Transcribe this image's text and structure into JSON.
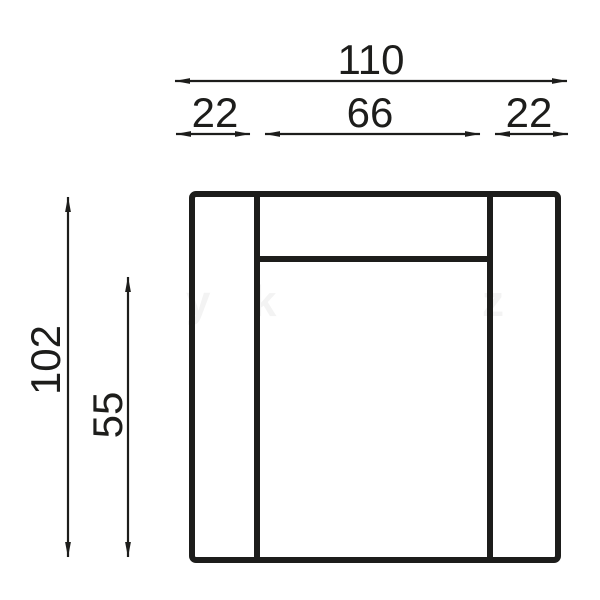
{
  "drawing": {
    "subject": "armchair-top-view-technical-drawing",
    "line_color": "#1d1d1b",
    "background_color": "#ffffff"
  },
  "dimensions": {
    "total_width": "110",
    "left_armrest_width": "22",
    "seat_width": "66",
    "right_armrest_width": "22",
    "total_depth": "102",
    "seat_depth": "55"
  },
  "watermark": {
    "glyphs": [
      "y",
      "k",
      "z"
    ],
    "color": "#1d1d1b"
  }
}
